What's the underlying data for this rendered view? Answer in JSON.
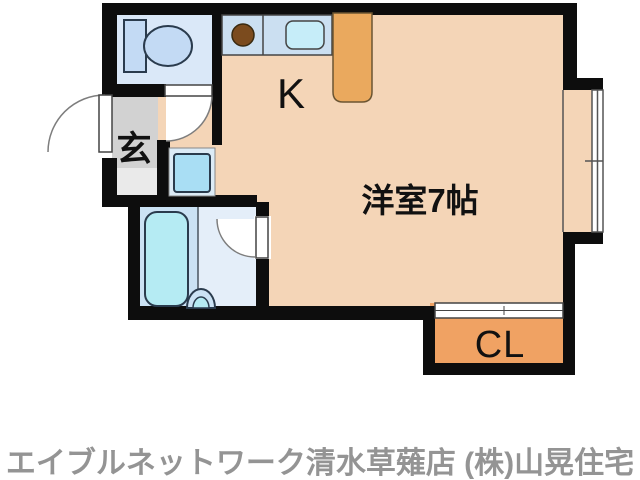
{
  "floorplan": {
    "labels": {
      "kitchen": "K",
      "main_room": "洋室7帖",
      "entrance": "玄",
      "closet": "CL"
    },
    "colors": {
      "wall": "#0d0d0d",
      "room_peach": "#f4d5b7",
      "toilet_floor": "#dae8f8",
      "bath_floor_wet": "#cbe2f4",
      "bath_floor_dry": "#e4eef9",
      "entry_floor": "#d2d2d2",
      "entry_step": "#eaeaea",
      "closet_orange": "#f0a263",
      "counter_blue": "#cbdff1",
      "sink_cyan": "#c6edf9",
      "fixture_cyan": "#b5ebf3",
      "fixture_blue": "#c3daf4",
      "washer_cyan": "#a9def4",
      "washer_frame": "#dcebf6",
      "fridge_orange": "#eaa95e",
      "stove_brown": "#7b4b1e",
      "caption_gray": "#949494"
    }
  },
  "caption": "エイブルネットワーク清水草薙店 (株)山晃住宅"
}
